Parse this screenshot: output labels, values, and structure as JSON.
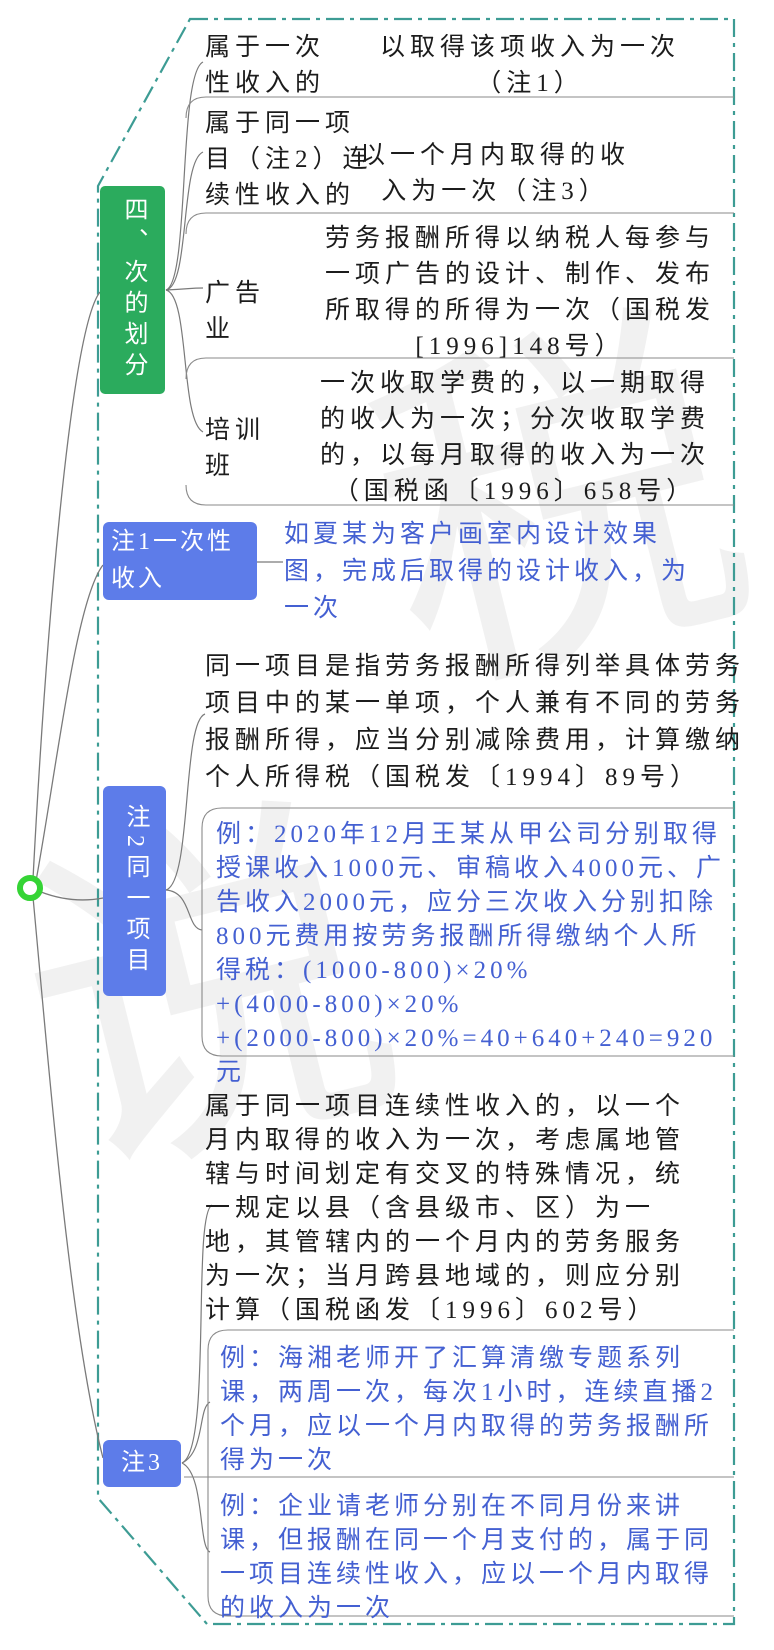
{
  "topic": {
    "label": "四、次的划分"
  },
  "branches": [
    {
      "label": "属于一次\n性收入的",
      "value": "以取得该项收入为一次\n（注1）"
    },
    {
      "label": "属于同一项\n目（注2）连\n续性收入的",
      "value": "以一个月内取得的收\n入为一次（注3）"
    },
    {
      "label": "广告\n业",
      "value": "劳务报酬所得以纳税人每参与一项广告的设计、制作、发布所取得的所得为一次（国税发[1996]148号）"
    },
    {
      "label": "培训\n班",
      "value": "一次收取学费的，以一期取得的收人为一次；分次收取学费的，以每月取得的收入为一次（国税函〔1996〕658号）"
    }
  ],
  "note1": {
    "label": "注1一次性收入",
    "example": "如夏某为客户画室内设计效果图，完成后取得的设计收入，为一次"
  },
  "note2": {
    "label": "注2同一项目",
    "definition": "同一项目是指劳务报酬所得列举具体劳务项目中的某一单项，个人兼有不同的劳务报酬所得，应当分别减除费用，计算缴纳个人所得税（国税发〔1994〕89号）",
    "example": "例：2020年12月王某从甲公司分别取得授课收入1000元、审稿收入4000元、广告收入2000元，应分三次收入分别扣除800元费用按劳务报酬所得缴纳个人所得税：(1000-800)×20%\n+(4000-800)×20%\n+(2000-800)×20%=40+640+240=920元"
  },
  "note3": {
    "label": "注3",
    "definition": "属于同一项目连续性收入的，以一个月内取得的收入为一次，考虑属地管辖与时间划定有交叉的特殊情况，统一规定以县（含县级市、区）为一地，其管辖内的一个月内的劳务服务为一次；当月跨县地域的，则应分别计算（国税函发〔1996〕602号）",
    "example1": "例：海湘老师开了汇算清缴专题系列课，两周一次，每次1小时，连续直播2个月，应以一个月内取得的劳务报酬所得为一次",
    "example2": "例：企业请老师分别在不同月份来讲课，但报酬在同一个月支付的，属于同一项目连续性收入，应以一个月内取得的收入为一次"
  },
  "watermark": {
    "char1": "说",
    "char2": "税"
  },
  "colors": {
    "topic_green": "#2bab5d",
    "note_blue": "#5d7ce9",
    "blue_text": "#4460d2",
    "border_teal": "#3d9c94",
    "root_green": "#35d435"
  }
}
